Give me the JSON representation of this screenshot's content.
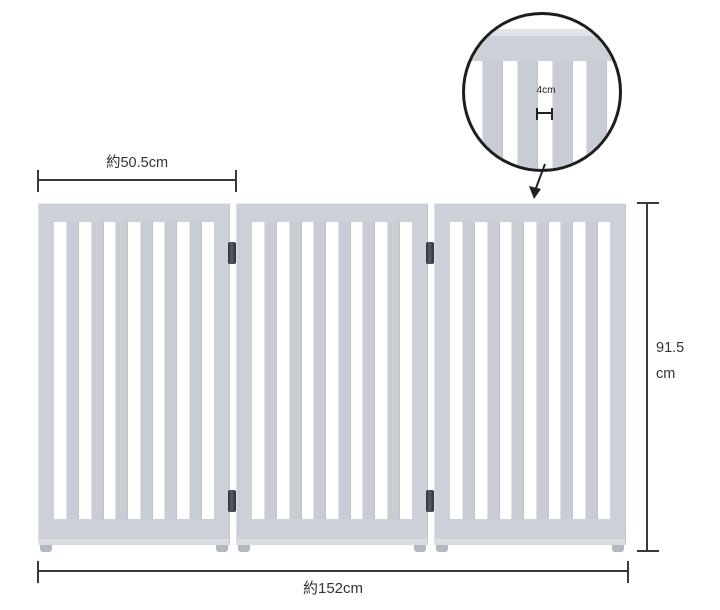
{
  "labels": {
    "panel_width": "約50.5cm",
    "total_width": "約152cm",
    "height_value": "91.5",
    "height_unit": "cm",
    "slat_gap": "4cm"
  },
  "gate": {
    "panel_count": 3,
    "slats_per_panel": 6,
    "colors": {
      "frame": "#ccd1d9",
      "slat": "#c7ccd5",
      "foot": "#b3b7c0",
      "hinge": "#565b64",
      "line": "#3a3a3a"
    }
  }
}
